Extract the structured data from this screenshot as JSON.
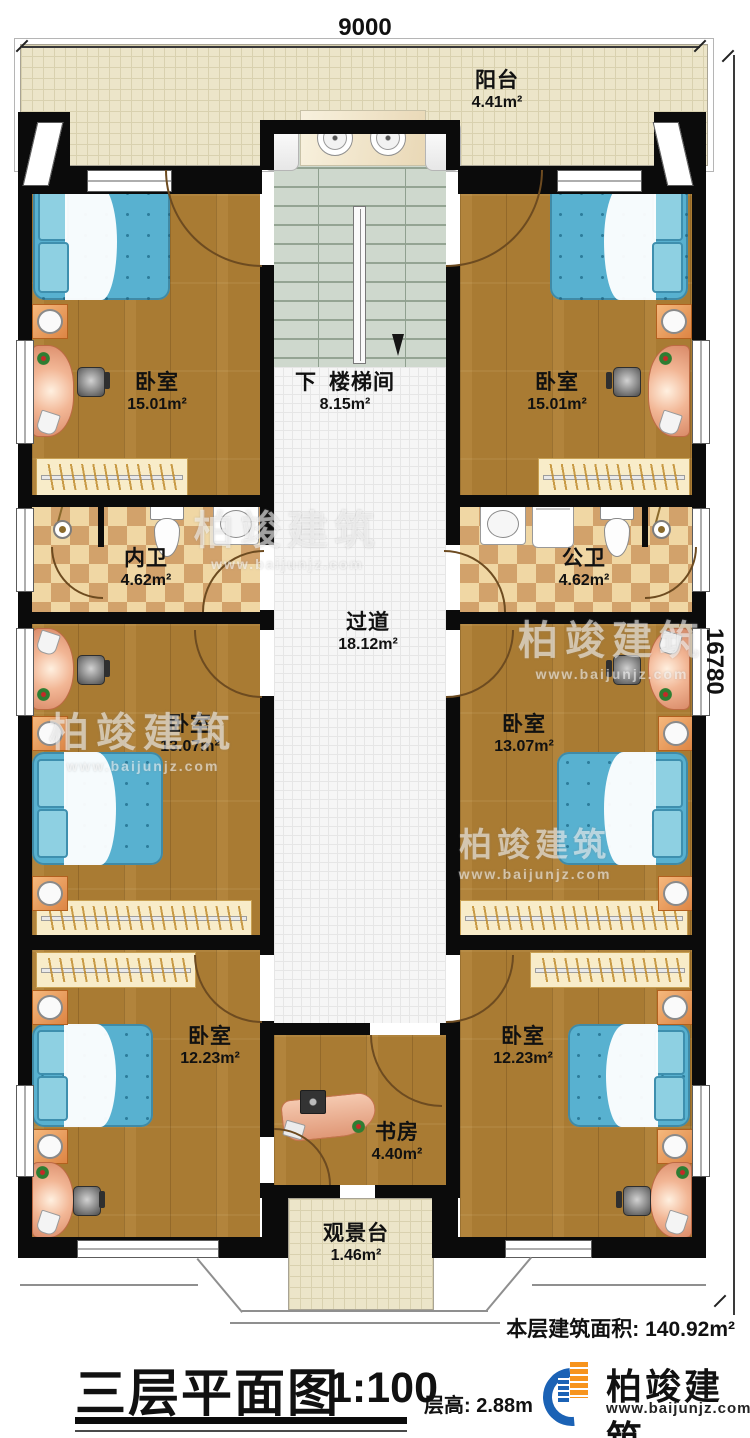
{
  "dimensions": {
    "top": "9000",
    "right": "16780"
  },
  "rooms": [
    {
      "id": "balcony",
      "name": "阳台",
      "area": "4.41m²"
    },
    {
      "id": "bedroom_top_left",
      "name": "卧室",
      "area": "15.01m²"
    },
    {
      "id": "bedroom_top_right",
      "name": "卧室",
      "area": "15.01m²"
    },
    {
      "id": "stairwell",
      "direction": "下",
      "name": "楼梯间",
      "area": "8.15m²"
    },
    {
      "id": "bath_inner",
      "name": "内卫",
      "area": "4.62m²"
    },
    {
      "id": "bath_public",
      "name": "公卫",
      "area": "4.62m²"
    },
    {
      "id": "corridor",
      "name": "过道",
      "area": "18.12m²"
    },
    {
      "id": "bedroom_mid_left",
      "name": "卧室",
      "area": "13.07m²"
    },
    {
      "id": "bedroom_mid_right",
      "name": "卧室",
      "area": "13.07m²"
    },
    {
      "id": "bedroom_bottom_left",
      "name": "卧室",
      "area": "12.23m²"
    },
    {
      "id": "bedroom_bottom_right",
      "name": "卧室",
      "area": "12.23m²"
    },
    {
      "id": "study",
      "name": "书房",
      "area": "4.40m²"
    },
    {
      "id": "view_deck",
      "name": "观景台",
      "area": "1.46m²"
    }
  ],
  "footer": {
    "floor_area_label": "本层建筑面积:",
    "floor_area_value": "140.92m²",
    "title": "三层平面图",
    "scale": "1:100",
    "floor_height_label": "层高:",
    "floor_height_value": "2.88m"
  },
  "branding": {
    "company": "柏竣建筑",
    "website": "www.baijunjz.com"
  },
  "watermark": {
    "text": "柏竣建筑",
    "url": "www.baijunjz.com"
  },
  "colors": {
    "wood": "#a97b33",
    "tile_light": "#f0d7a4",
    "tile_dark": "#d2a26b",
    "stair": "#ced8cd",
    "corridor": "#f6f6f6",
    "balcony": "#ece5c9",
    "bed": "#58b1d0",
    "wall": "#0b0b0b",
    "logo_blue": "#1b62b5",
    "logo_orange": "#f7941d"
  }
}
